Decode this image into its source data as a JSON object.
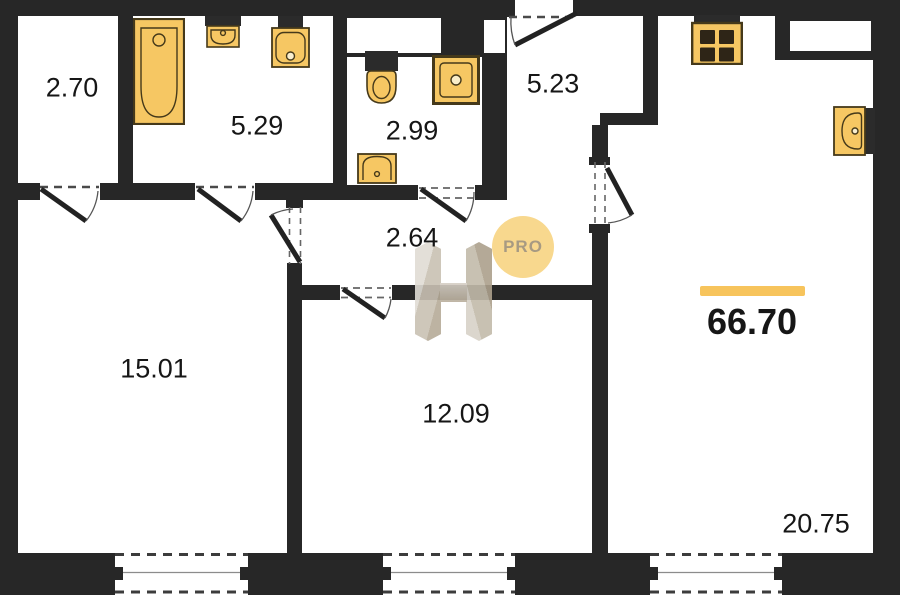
{
  "plan": {
    "total_area": "66.70",
    "rooms": [
      {
        "area": "2.70"
      },
      {
        "area": "5.29"
      },
      {
        "area": "2.99"
      },
      {
        "area": "5.23"
      },
      {
        "area": "2.64"
      },
      {
        "area": "15.01"
      },
      {
        "area": "12.09"
      },
      {
        "area": "20.75"
      }
    ],
    "fixture_icons": [
      "bathtub-icon",
      "sink-icon",
      "sink-icon",
      "toilet-icon",
      "washing-machine-icon",
      "sink-icon",
      "stove-icon",
      "sink-icon"
    ]
  },
  "watermark": {
    "badge": "PRO"
  },
  "colors": {
    "wall": "#272727",
    "fixture_fill": "#F6C763",
    "fixture_border": "#45391A",
    "fixture_dark": "#2B2B2B",
    "accent_bar": "#F7C45C",
    "badge_bg": "#F8D88E",
    "badge_text": "#A79A82",
    "label": "#161616"
  }
}
